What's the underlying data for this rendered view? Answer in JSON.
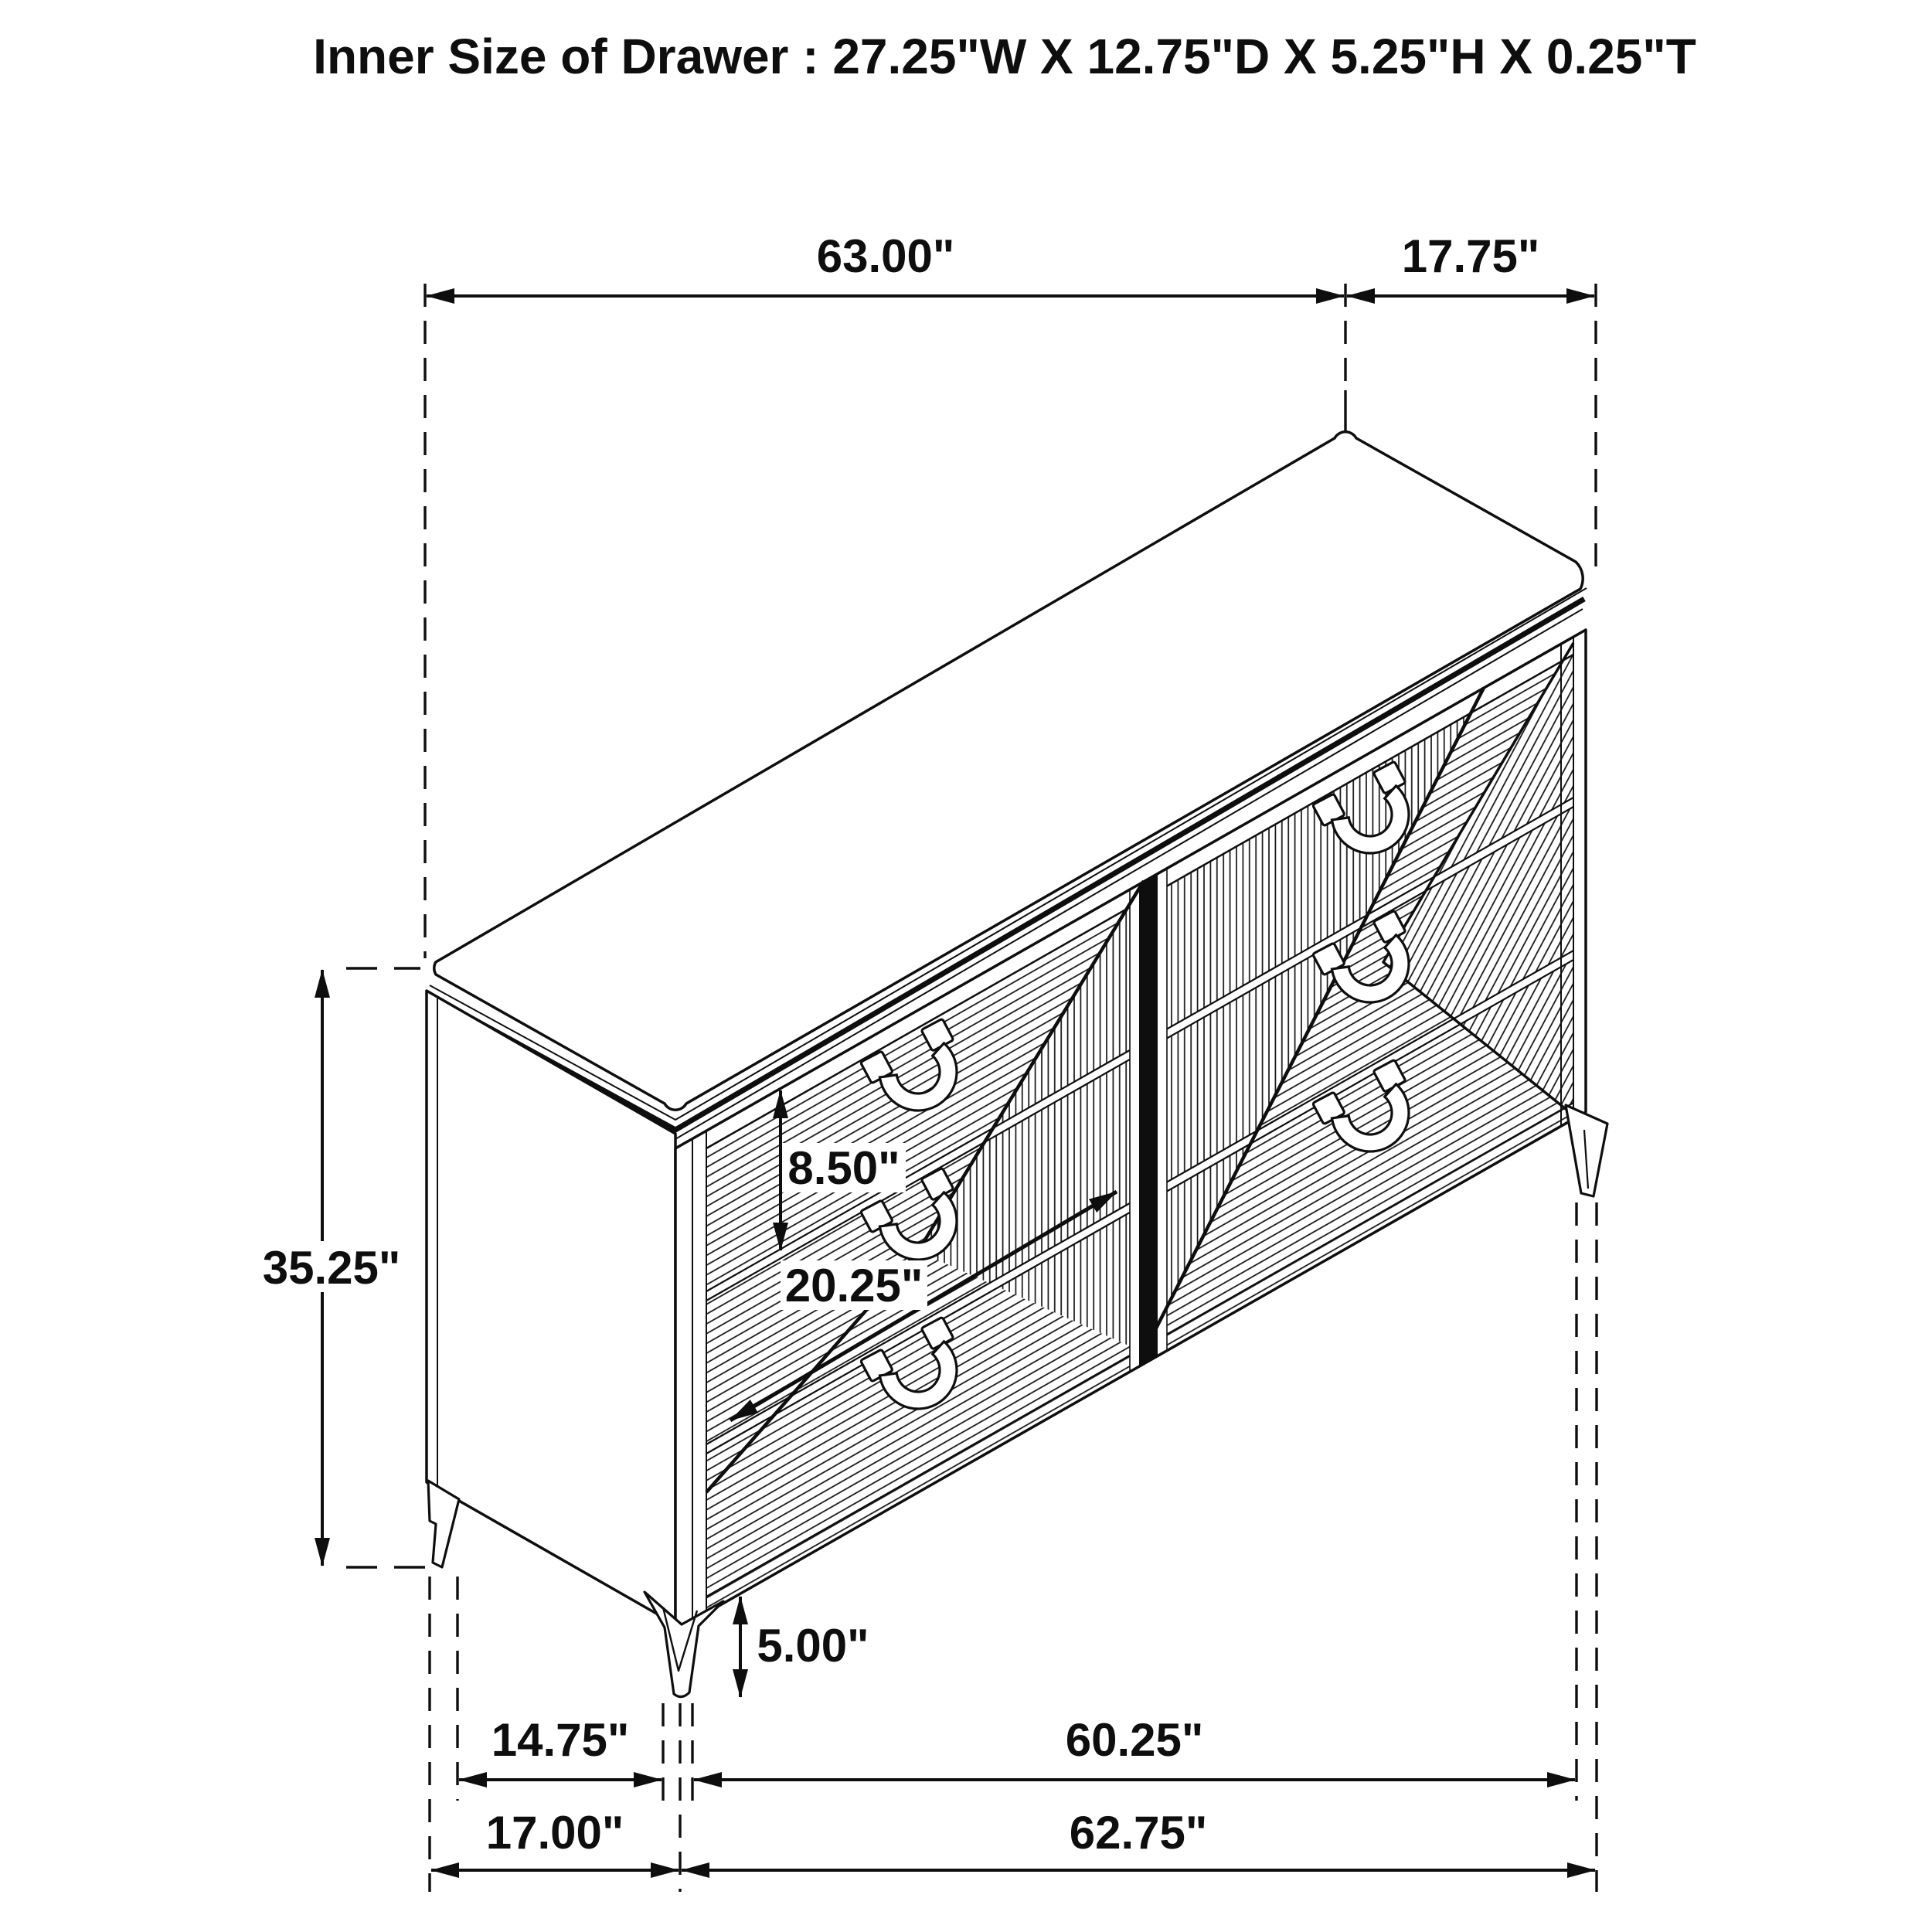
{
  "title": "Inner Size of Drawer : 27.25\"W X 12.75\"D X 5.25\"H X 0.25\"T",
  "diagram_type": "furniture-dimension-drawing",
  "item": "6-drawer dresser isometric line drawing",
  "colors": {
    "line": "#0e0e0e",
    "background": "#ffffff"
  },
  "dimensions": {
    "top_width": {
      "label": "63.00\""
    },
    "top_depth": {
      "label": "17.75\""
    },
    "overall_height": {
      "label": "35.25\""
    },
    "drawer_front_height": {
      "label": "8.50\""
    },
    "drawer_front_width": {
      "label": "20.25\""
    },
    "leg_height": {
      "label": "5.00\""
    },
    "leg_inset": {
      "label": "14.75\""
    },
    "leg_span": {
      "label": "60.25\""
    },
    "base_left": {
      "label": "17.00\""
    },
    "base_width": {
      "label": "62.75\""
    }
  }
}
